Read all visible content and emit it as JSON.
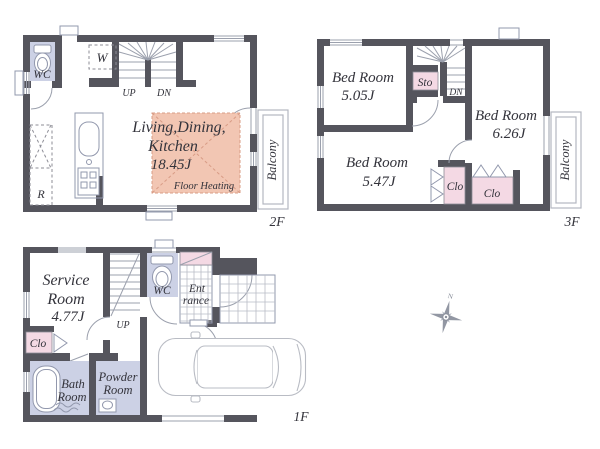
{
  "colors": {
    "wall_gray": "#55555d",
    "wet_area_fill": "#ccd1e5",
    "closet_fill": "#f4d9e4",
    "floor_heating_fill": "#f2c6b3",
    "line_gray": "#9ba0ad",
    "text_color": "#33333b"
  },
  "floors": {
    "f2": {
      "label": "2F",
      "wc": "WC",
      "closet_w": "W",
      "up": "UP",
      "dn": "DN",
      "ldk_l1": "Living,Dining,",
      "ldk_l2": "Kitchen",
      "ldk_l3": "18.45J",
      "floor_heating": "Floor Heating",
      "balcony": "Balcony",
      "r": "R"
    },
    "f3": {
      "label": "3F",
      "bed1_name": "Bed Room",
      "bed1_size": "5.05J",
      "bed2_name": "Bed Room",
      "bed2_size": "6.26J",
      "bed3_name": "Bed Room",
      "bed3_size": "5.47J",
      "sto": "Sto",
      "dn": "DN",
      "clo1": "Clo",
      "clo2": "Clo",
      "balcony": "Balcony"
    },
    "f1": {
      "label": "1F",
      "service_l1": "Service",
      "service_l2": "Room",
      "service_l3": "4.77J",
      "up": "UP",
      "wc": "WC",
      "entrance_l1": "Ent",
      "entrance_l2": "rance",
      "clo": "Clo",
      "bath_l1": "Bath",
      "bath_l2": "Room",
      "powder_l1": "Powder",
      "powder_l2": "Room"
    }
  },
  "compass": {
    "north": "N"
  }
}
